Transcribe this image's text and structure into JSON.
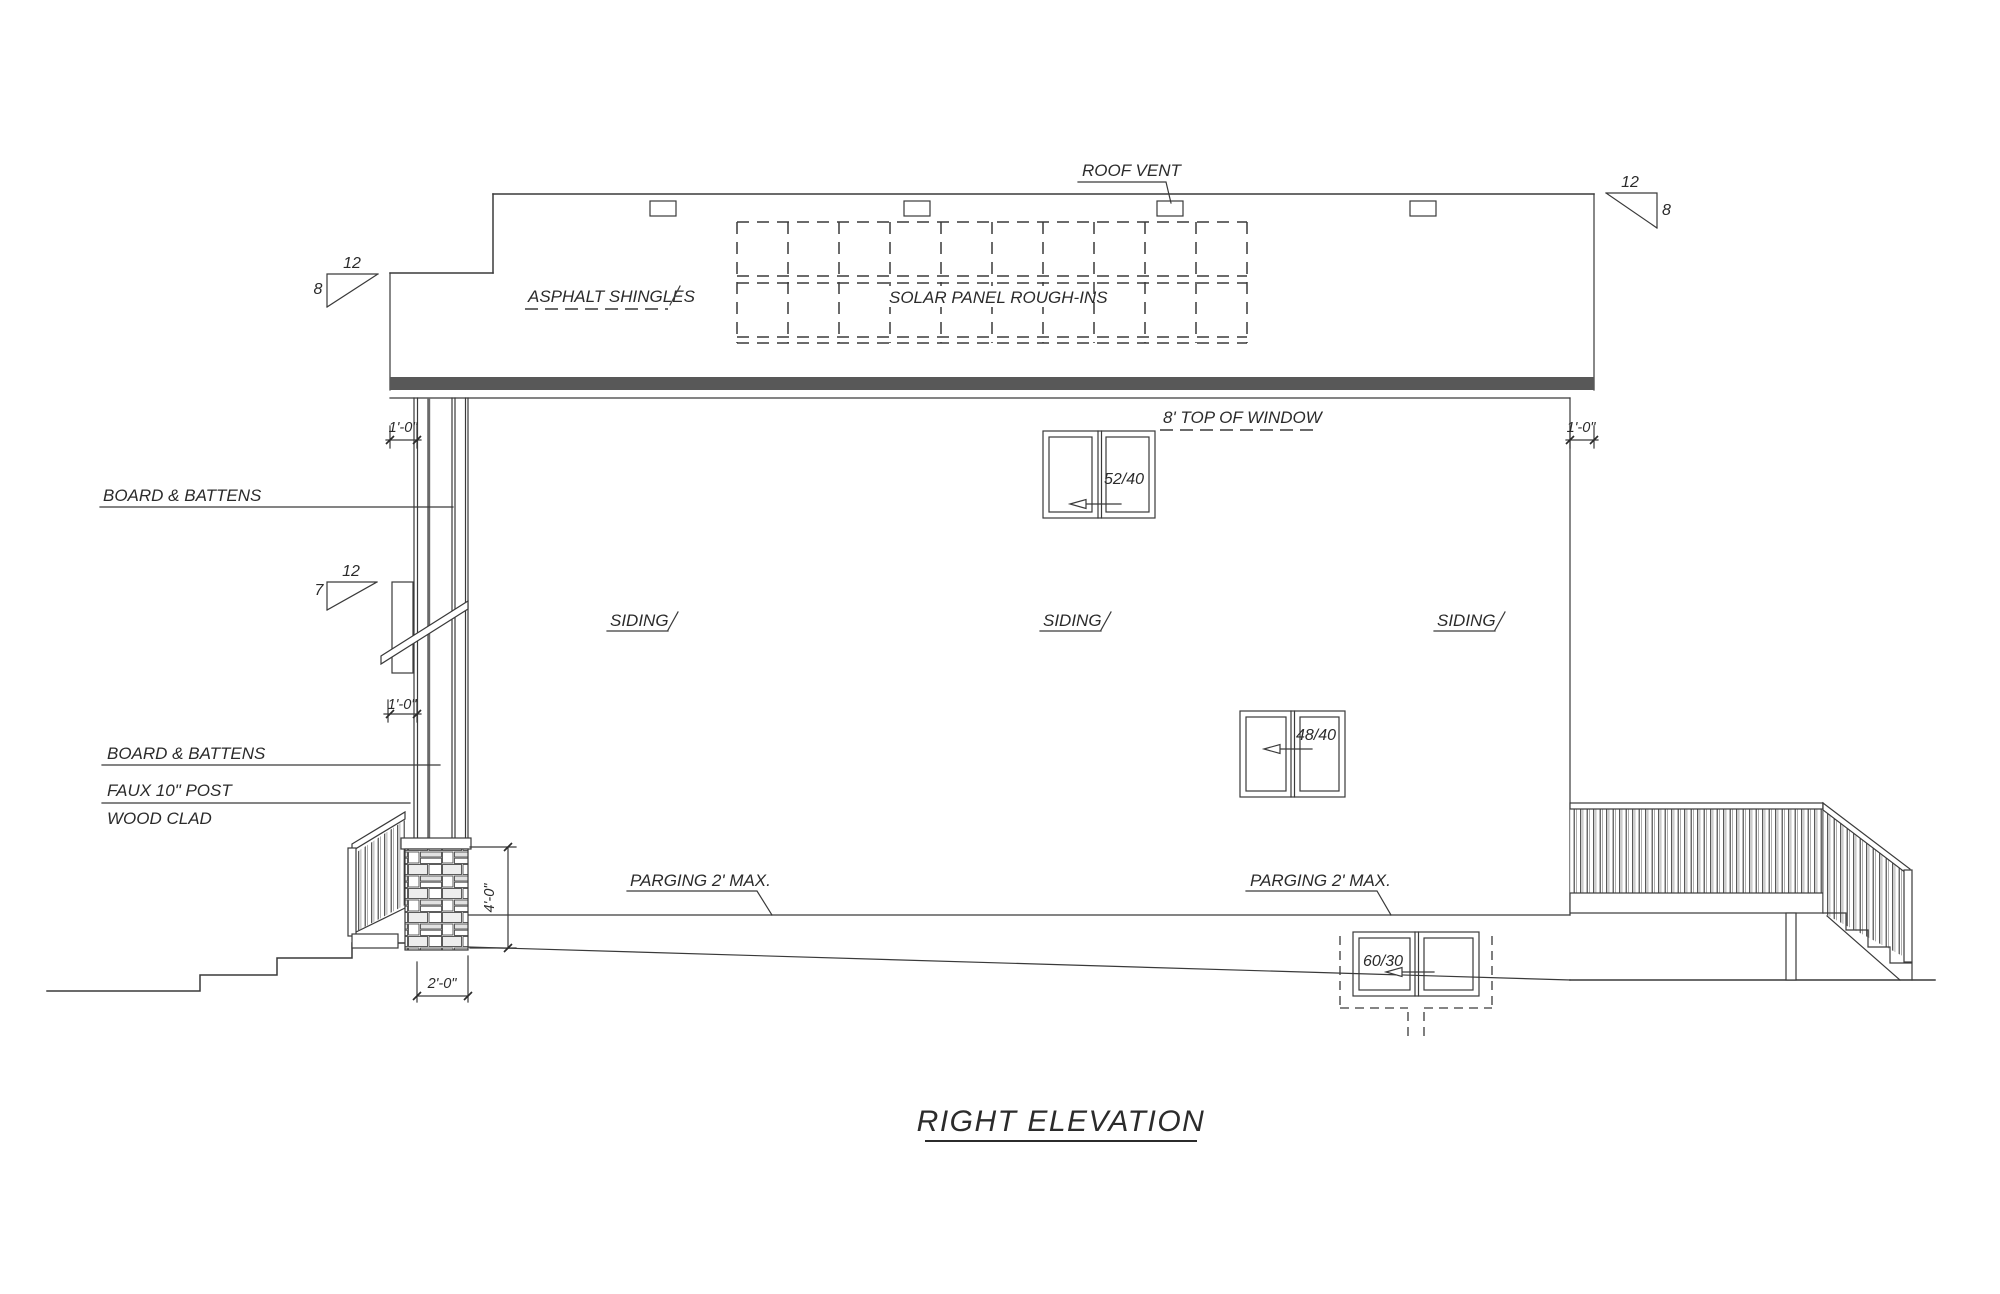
{
  "drawing": {
    "title": "RIGHT ELEVATION",
    "labels": {
      "roof_vent": "ROOF VENT",
      "asphalt_shingles": "ASPHALT SHINGLES",
      "solar_panel": "SOLAR PANEL ROUGH-INS",
      "top_of_window": "8' TOP OF WINDOW",
      "board_battens_upper": "BOARD & BATTENS",
      "board_battens_lower": "BOARD & BATTENS",
      "faux_post": "FAUX 10\" POST",
      "wood_clad": "WOOD CLAD",
      "siding_left": "SIDING",
      "siding_center": "SIDING",
      "siding_right": "SIDING",
      "parging_left": "PARGING 2' MAX.",
      "parging_right": "PARGING 2' MAX."
    },
    "windows": {
      "upper_label": "52/40",
      "middle_label": "48/40",
      "basement_label": "60/30"
    },
    "slopes": {
      "main_left": {
        "run": "12",
        "rise": "8"
      },
      "main_right": {
        "run": "12",
        "rise": "8"
      },
      "porch": {
        "run": "12",
        "rise": "7"
      }
    },
    "dimensions": {
      "eave_left": "1'-0\"",
      "eave_right": "1'-0\"",
      "porch_eave": "1'-0\"",
      "post_height": "4'-0\"",
      "post_width": "2'-0\""
    },
    "colors": {
      "line": "#3a3a3a",
      "text": "#2b2b2b",
      "background": "#ffffff"
    }
  }
}
